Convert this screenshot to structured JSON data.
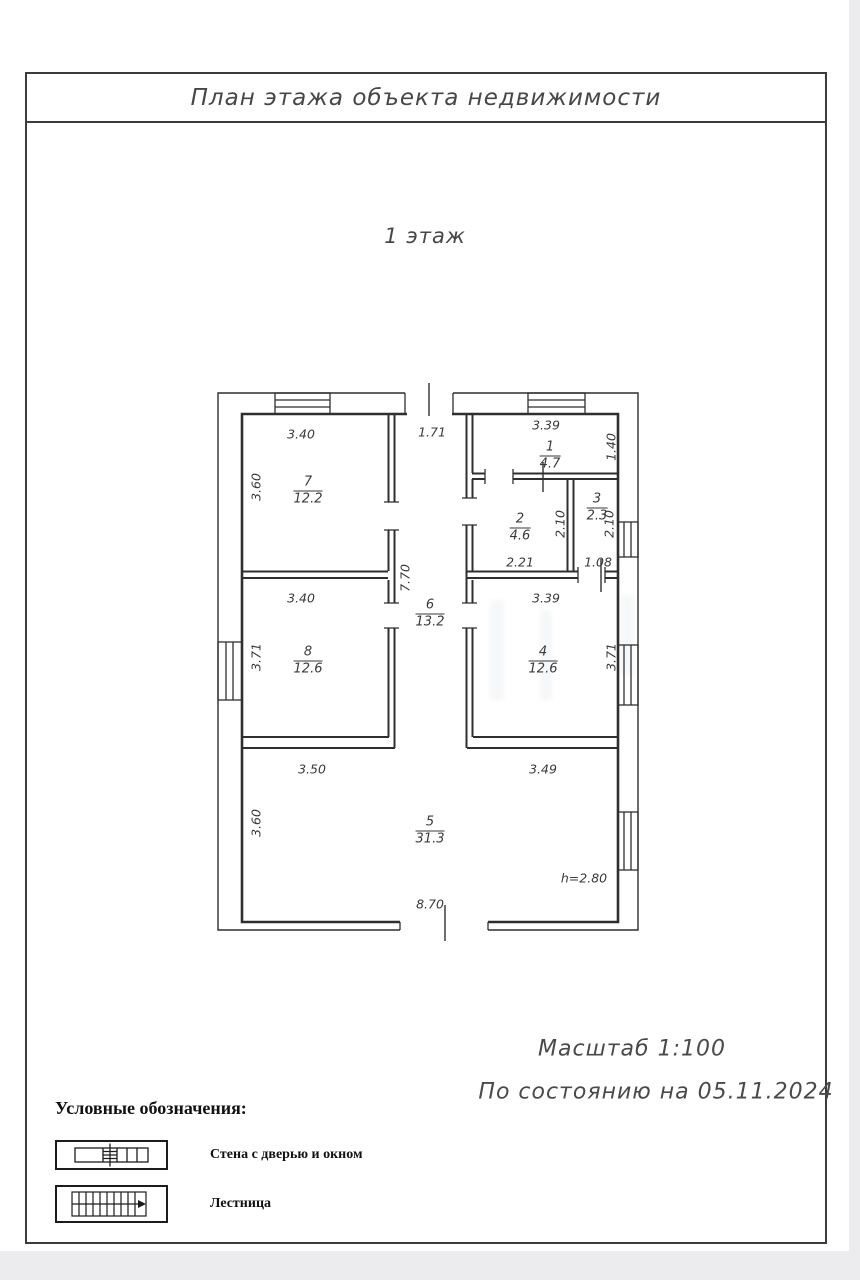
{
  "page": {
    "title": "План этажа объекта недвижимости",
    "floor_label": "1 этаж",
    "scale_label": "Масштаб 1:100",
    "date_label": "По состоянию на 05.11.2024"
  },
  "plan": {
    "rooms": [
      {
        "number": "1",
        "area": "4.7",
        "x": 550,
        "y": 456
      },
      {
        "number": "2",
        "area": "4.6",
        "x": 520,
        "y": 528
      },
      {
        "number": "3",
        "area": "2.3",
        "x": 597,
        "y": 508
      },
      {
        "number": "4",
        "area": "12.6",
        "x": 543,
        "y": 661
      },
      {
        "number": "5",
        "area": "31.3",
        "x": 430,
        "y": 831
      },
      {
        "number": "6",
        "area": "13.2",
        "x": 430,
        "y": 614
      },
      {
        "number": "7",
        "area": "12.2",
        "x": 308,
        "y": 491
      },
      {
        "number": "8",
        "area": "12.6",
        "x": 308,
        "y": 661
      }
    ],
    "dimensions": [
      {
        "text": "3.40",
        "x": 301,
        "y": 434,
        "rot": false
      },
      {
        "text": "1.71",
        "x": 432,
        "y": 432,
        "rot": false
      },
      {
        "text": "3.39",
        "x": 546,
        "y": 425,
        "rot": false
      },
      {
        "text": "1.40",
        "x": 611,
        "y": 447,
        "rot": true
      },
      {
        "text": "3.60",
        "x": 256,
        "y": 487,
        "rot": true
      },
      {
        "text": "2.10",
        "x": 560,
        "y": 524,
        "rot": true
      },
      {
        "text": "2.10",
        "x": 609,
        "y": 524,
        "rot": true
      },
      {
        "text": "2.21",
        "x": 520,
        "y": 562,
        "rot": false
      },
      {
        "text": "1.08",
        "x": 598,
        "y": 562,
        "rot": false
      },
      {
        "text": "7.70",
        "x": 405,
        "y": 578,
        "rot": true
      },
      {
        "text": "3.40",
        "x": 301,
        "y": 598,
        "rot": false
      },
      {
        "text": "3.39",
        "x": 546,
        "y": 598,
        "rot": false
      },
      {
        "text": "3.71",
        "x": 256,
        "y": 657,
        "rot": true
      },
      {
        "text": "3.71",
        "x": 611,
        "y": 657,
        "rot": true
      },
      {
        "text": "3.50",
        "x": 312,
        "y": 769,
        "rot": false
      },
      {
        "text": "3.49",
        "x": 543,
        "y": 769,
        "rot": false
      },
      {
        "text": "3.60",
        "x": 256,
        "y": 823,
        "rot": true
      },
      {
        "text": "8.70",
        "x": 430,
        "y": 904,
        "rot": false
      },
      {
        "text": "h=2.80",
        "x": 584,
        "y": 878,
        "rot": false
      }
    ]
  },
  "legend": {
    "header": "Условные обозначения:",
    "items": [
      {
        "label": "Стена с дверью и окном"
      },
      {
        "label": "Лестница"
      }
    ]
  },
  "colors": {
    "wall_line": "#2f2f2f",
    "text": "#3a3a3a",
    "frame": "#3c3c3c",
    "margin_gray": "#ececee"
  }
}
